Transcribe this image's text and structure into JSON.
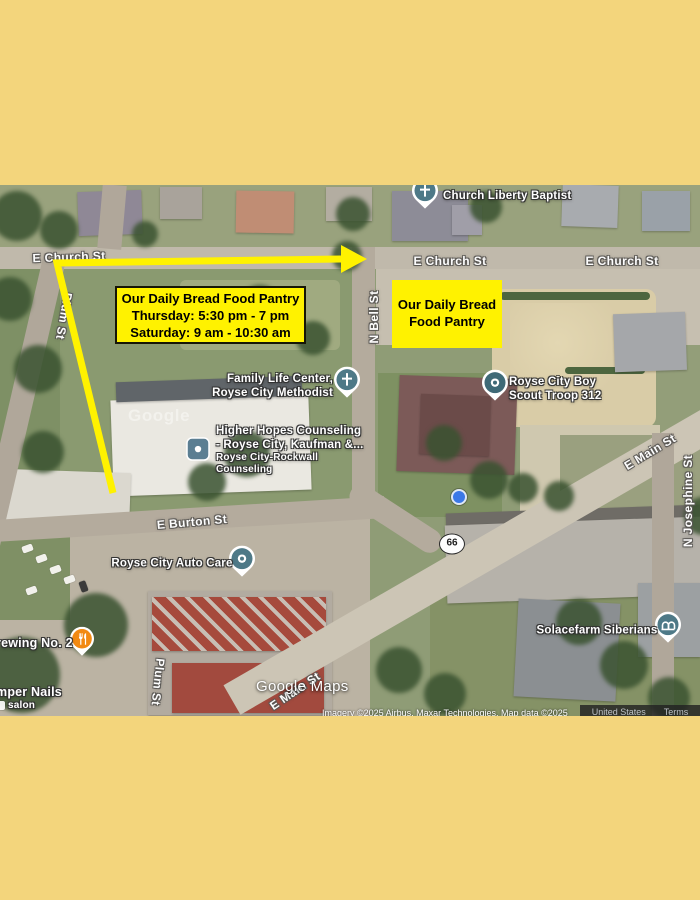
{
  "page": {
    "background": "#F3D57C"
  },
  "annotations": {
    "highlight_color": "#FFF200",
    "route_box": {
      "line1": "Our Daily Bread Food Pantry",
      "line2": "Thursday: 5:30 pm - 7 pm",
      "line3": "Saturday: 9 am - 10:30 am"
    },
    "location_box": {
      "line1": "Our Daily Bread",
      "line2": "Food Pantry"
    }
  },
  "streets": {
    "church_left": "E Church St",
    "church_mid": "E Church St",
    "church_right": "E Church St",
    "bell": "N Bell St",
    "plum_upper": "Plum St",
    "plum_lower": "Plum St",
    "burton": "E Burton St",
    "main_right": "E Main St",
    "main_bottom": "E Main St",
    "josephine": "N Josephine St"
  },
  "route_shield": {
    "number": "66"
  },
  "pois": {
    "church_liberty": {
      "label": "Church Liberty Baptist",
      "icon": "church-pin-icon"
    },
    "family_life": {
      "line1": "Family Life Center,",
      "line2": "Royse City Methodist",
      "icon": "church-pin-icon"
    },
    "higher_hopes": {
      "line1": "Higher Hopes Counseling",
      "line2": "- Royse City, Kaufman &...",
      "sub_line1": "Royse City-Rockwall",
      "sub_line2": "Counseling",
      "icon": "office-icon"
    },
    "boy_scout": {
      "line1": "Royse City Boy",
      "line2": "Scout Troop 312",
      "icon": "place-pin-icon"
    },
    "auto_care": {
      "label": "Royse City Auto Care",
      "icon": "place-pin-icon"
    },
    "solacefarm": {
      "label": "Solacefarm Siberians",
      "icon": "kennel-pin-icon"
    },
    "brewing": {
      "label": "rewing No. 2",
      "icon": "restaurant-icon"
    },
    "nails": {
      "label": "mper Nails",
      "sub_label": "salon",
      "icon": "salon-icon"
    }
  },
  "markers": {
    "pin_color": "#4E7987",
    "restaurant_color": "#F28A12",
    "location_dot_color": "#3B78E7"
  },
  "watermark": {
    "text": "Google Maps",
    "imagery_ghost": "Google"
  },
  "attribution": {
    "imagery": "Imagery ©2025 Airbus, Maxar Technologies, Map data ©2025",
    "region": "United States",
    "terms": "Terms",
    "privacy": "Privacy"
  }
}
